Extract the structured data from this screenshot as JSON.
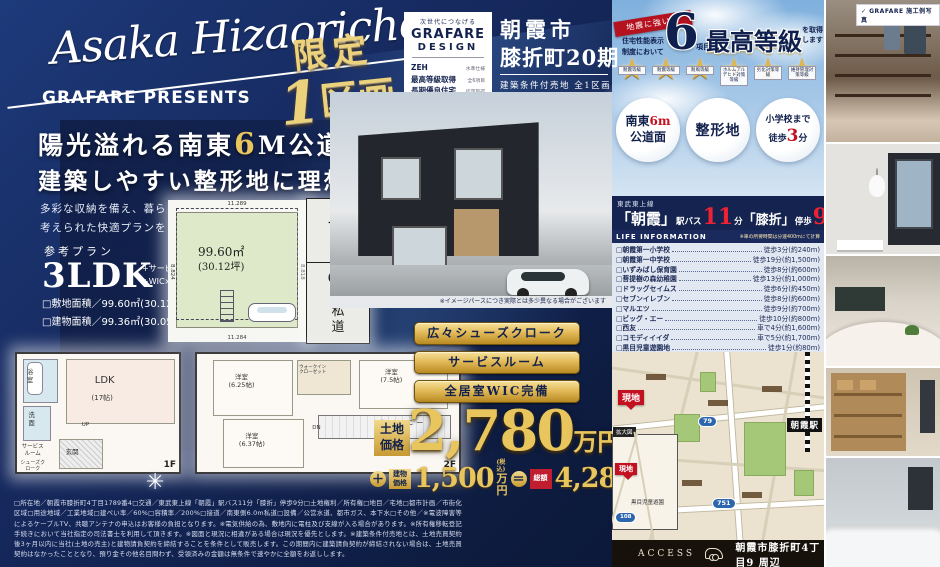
{
  "brand": {
    "script": "Asaka Hizaoricho",
    "presents": "GRAFARE PRESENTS",
    "check": "✓",
    "photo_label": "GRAFARE 施工例写真"
  },
  "limited": {
    "l1": "限定",
    "l2_num": "1",
    "l2_txt": "区画"
  },
  "headline": {
    "line1a": "陽光溢れる南東",
    "line1b": "6",
    "line1c": "M公道面！",
    "line2": "建築しやすい整形地に理想の邸宅を建てる",
    "sub1": "多彩な収納を備え、暮らしやすいよう生活動線が",
    "sub2": "考えられた快適プランをご提案します。"
  },
  "plan": {
    "label": "参考プラン",
    "type": "3LDK",
    "opt1": "+サービスルーム",
    "opt2": "+WIC×3+SC+パントリー",
    "site": "□敷地面積／99.60㎡(30.12坪)",
    "bldg": "□建物面積／99.36㎡(30.05坪)"
  },
  "lot": {
    "area": "99.60㎡",
    "tsubo": "(30.12坪)",
    "dim_top": "11.289",
    "dim_bottom": "11.284",
    "dim_left": "8.824",
    "dim_right": "8.818",
    "compass_n": "N",
    "road_num": "6.0",
    "road_m": "M",
    "road_txt": "私道"
  },
  "floorplan": {
    "f1": {
      "label": "1F",
      "bath": "浴室",
      "wash": "洗面",
      "ldk": "LDK",
      "ldk_size": "(17帖)",
      "up": "UP",
      "service": "サービスルーム",
      "entrance": "玄関",
      "shoes": "シューズクローク"
    },
    "f2": {
      "label": "2F",
      "r1": "洋室",
      "r1s": "(6.25帖)",
      "wic": "ウォークインクローゼット",
      "r2": "洋室",
      "r2s": "(7.5帖)",
      "r3": "洋室",
      "r3s": "(6.37帖)",
      "balcony": "バルコニー",
      "dn": "DN"
    }
  },
  "design_box": {
    "tagline": "次世代につなげる",
    "name1": "GRAFARE",
    "name2": "DESIGN",
    "r1l": "ZEH",
    "r1r": "水準仕様",
    "r2l": "最高等級取得",
    "r2r": "全6項目",
    "r3l": "長期優良住宅",
    "r3r": "認定取得"
  },
  "location": {
    "city": "朝霞市",
    "town": "膝折町20期",
    "sub": "建築条件付売地 全1区画"
  },
  "render_caption": "※イメージパースにつき実際とは多少異なる場合がございます",
  "features": {
    "b1": "広々シューズクローク",
    "b2": "サービスルーム",
    "b3": "全居室WIC完備"
  },
  "price": {
    "land_label": "土地価格",
    "land_amount": "2,780",
    "man_yen": "万円",
    "plus": "＋",
    "building_label": "建物価格",
    "building_amount": "1,500",
    "tax_note": "(税込)",
    "equals": "＝",
    "total_label": "総額",
    "total_amount": "4,280"
  },
  "performance": {
    "ribbon": "地震に強い家",
    "lead1": "住宅性能表示",
    "lead2": "制度において",
    "big": "6",
    "unit": "項目",
    "grade": "最高等級",
    "tail1": "を取得",
    "tail2": "します",
    "stars": [
      {
        "label": "耐震等級"
      },
      {
        "label": "耐震等級"
      },
      {
        "label": "耐風等級"
      },
      {
        "label": "ホルムアルデヒド対策等級"
      },
      {
        "label": "劣化対策等級"
      },
      {
        "label": "維持管理対策等級"
      }
    ]
  },
  "badge1": {
    "l1a": "南東",
    "l1b": "6m",
    "l2": "公道面"
  },
  "badge2": {
    "text": "整形地"
  },
  "badge3": {
    "l1": "小学校まで",
    "l2a": "徒歩",
    "l2b": "3",
    "l2c": "分"
  },
  "train": {
    "line": "東武東上線",
    "st1": "「朝霞」",
    "bus": "駅バス",
    "n1": "11",
    "min": "分",
    "st2": "「膝折」",
    "walk": "停歩",
    "n2": "9"
  },
  "life_info": {
    "header": "LIFE INFORMATION",
    "note": "※車の所要時間は分速400mにて計算",
    "items": [
      {
        "name": "□朝霞第一小学校",
        "time": "徒歩3分(約240m)"
      },
      {
        "name": "□朝霞第一中学校",
        "time": "徒歩19分(約1,500m)"
      },
      {
        "name": "□いずみばし保育園",
        "time": "徒歩8分(約600m)"
      },
      {
        "name": "□菩提樹の森幼稚園",
        "time": "徒歩13分(約1,000m)"
      },
      {
        "name": "□ドラッグセイムス",
        "time": "徒歩6分(約450m)"
      },
      {
        "name": "□セブンイレブン",
        "time": "徒歩8分(約600m)"
      },
      {
        "name": "□マルエツ",
        "time": "徒歩9分(約700m)"
      },
      {
        "name": "□ビッグ・エー",
        "time": "徒歩10分(約800m)"
      },
      {
        "name": "□西友",
        "time": "車で4分(約1,600m)"
      },
      {
        "name": "□コモディイイダ",
        "time": "車で5分(約1,700m)"
      },
      {
        "name": "□黒目児童遊園地",
        "time": "徒歩1分(約80m)"
      }
    ]
  },
  "map": {
    "site": "現地",
    "station": "朝霞駅",
    "route1": "79",
    "route2": "751",
    "route3": "108",
    "inset_title": "拡大図",
    "inset_site": "現地",
    "inset_park": "黒目児童遊園"
  },
  "access": {
    "label": "ACCESS",
    "address": "朝霞市膝折町4丁目9 周辺"
  },
  "legal": "□所在地／朝霞市膝折町4丁目1789番4□交通／東武東上線「朝霞」駅バス11分「膝折」停歩9分□土地権利／所有権□地目／宅地□都市計画／市街化区域□用途地域／工業地域□建ぺい率／60%□容積率／200%□接道／南東側6.0m私道□設備／公営水道、都市ガス、本下水□その他／※電波障害等によるケーブルTV、共聴アンテナの申込はお客様の負担となります。※電気供給の為、敷地内に電柱及び支線が入る場合があります。※所有権移転登記手続きにおいて当社指定の司法書士を利用して頂きます。※図面と現況に相違がある場合は現況を優先とします。※建築条件付売地とは、土地売買契約後3ヶ月以内に当社(土地の売主)と建物請負契約を締結することを条件として販売します。この期間内に建築請負契約が締結されない場合は、土地売買契約はなかったこととなり、預り金その他名目問わず、受領済みの金額は無条件で速やかに全額をお返しします。"
}
